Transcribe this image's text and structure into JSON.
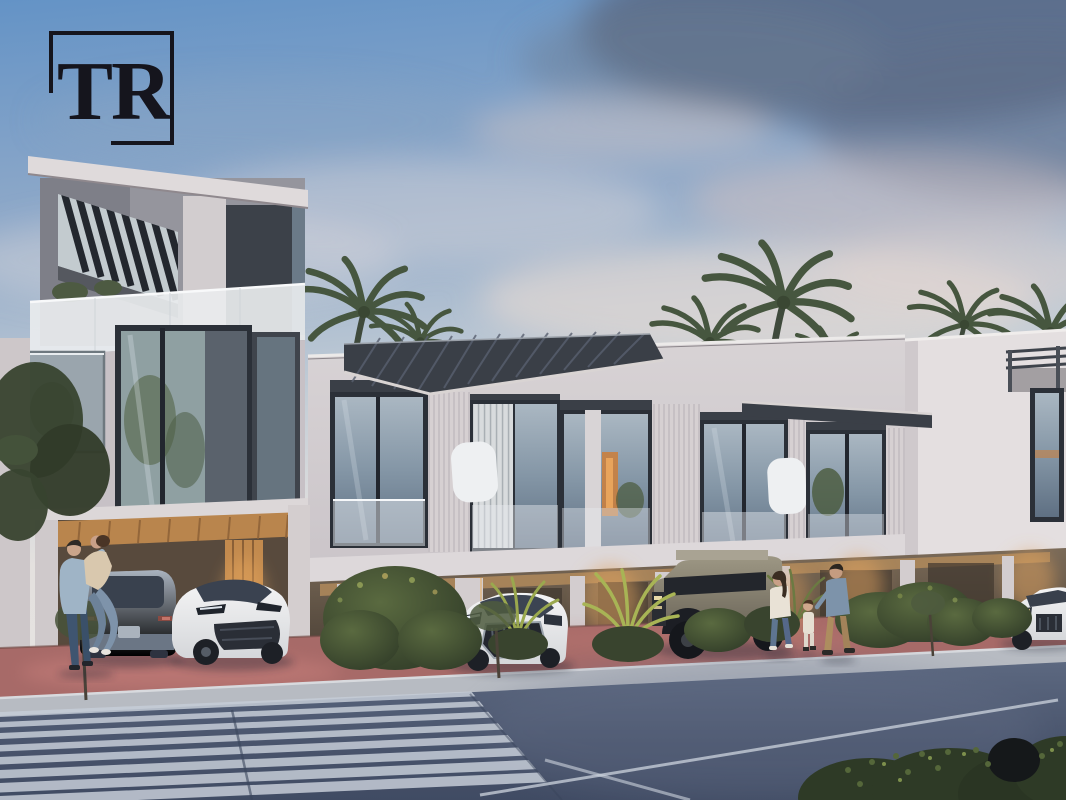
{
  "logo": {
    "text": "TR"
  },
  "scene": {
    "type": "architectural-dusk-render",
    "description": "Modern two-storey townhouse row at dusk with a three-storey end tower, slatted pergola roofs, glass balconies, warm-lit carports, palm trees, hedges, red paver driveway, sidewalk, dark road with striped pedestrian crossing",
    "objects": [
      "sky",
      "clouds",
      "palm-trees",
      "left-tower",
      "townhouse-row",
      "carports",
      "driveway-pavers",
      "sidewalk",
      "road",
      "crosswalk",
      "lane-markings",
      "parked-cars",
      "pedestrian-couple",
      "pedestrian-family",
      "hedges",
      "street-trees",
      "tr-logo"
    ],
    "cars": [
      {
        "name": "suv-rear",
        "color": "gray-blue"
      },
      {
        "name": "crossover-front",
        "color": "white"
      },
      {
        "name": "luxury-suv",
        "color": "white"
      },
      {
        "name": "electric-pickup",
        "color": "sand-tan"
      },
      {
        "name": "sedan-behind-hedge",
        "color": "dark-gray"
      },
      {
        "name": "suv-far-right",
        "color": "white"
      }
    ],
    "pedestrians": [
      {
        "name": "embracing-couple",
        "count": 2
      },
      {
        "name": "walking-family",
        "count": 3
      }
    ]
  },
  "palette": {
    "logo-ink": "#15151d",
    "palm": "#46563f",
    "roof-dark": "#3a3f47",
    "frame-dark": "#2b3038",
    "wall-light": "#d8d3d5",
    "wall-mid": "#c7c1c6",
    "wall-bright": "#e4dfe0",
    "sidewalk": "#b7bbc2",
    "paver-red": "#a76a68",
    "stripe": "#c6cdd8",
    "green-dark": "#35402e",
    "green-mid": "#51623c",
    "green-light": "#9aa84e",
    "car-white": "#eceded",
    "car-gray": "#97a2b0",
    "car-tan": "#8b8475",
    "glow": "#e2a35f",
    "glass-dark": "#3c4149",
    "sky-top": "#6493c6",
    "sky-low": "#e7e2df",
    "cloud-dark": "#55647e",
    "road": "#49546c"
  }
}
